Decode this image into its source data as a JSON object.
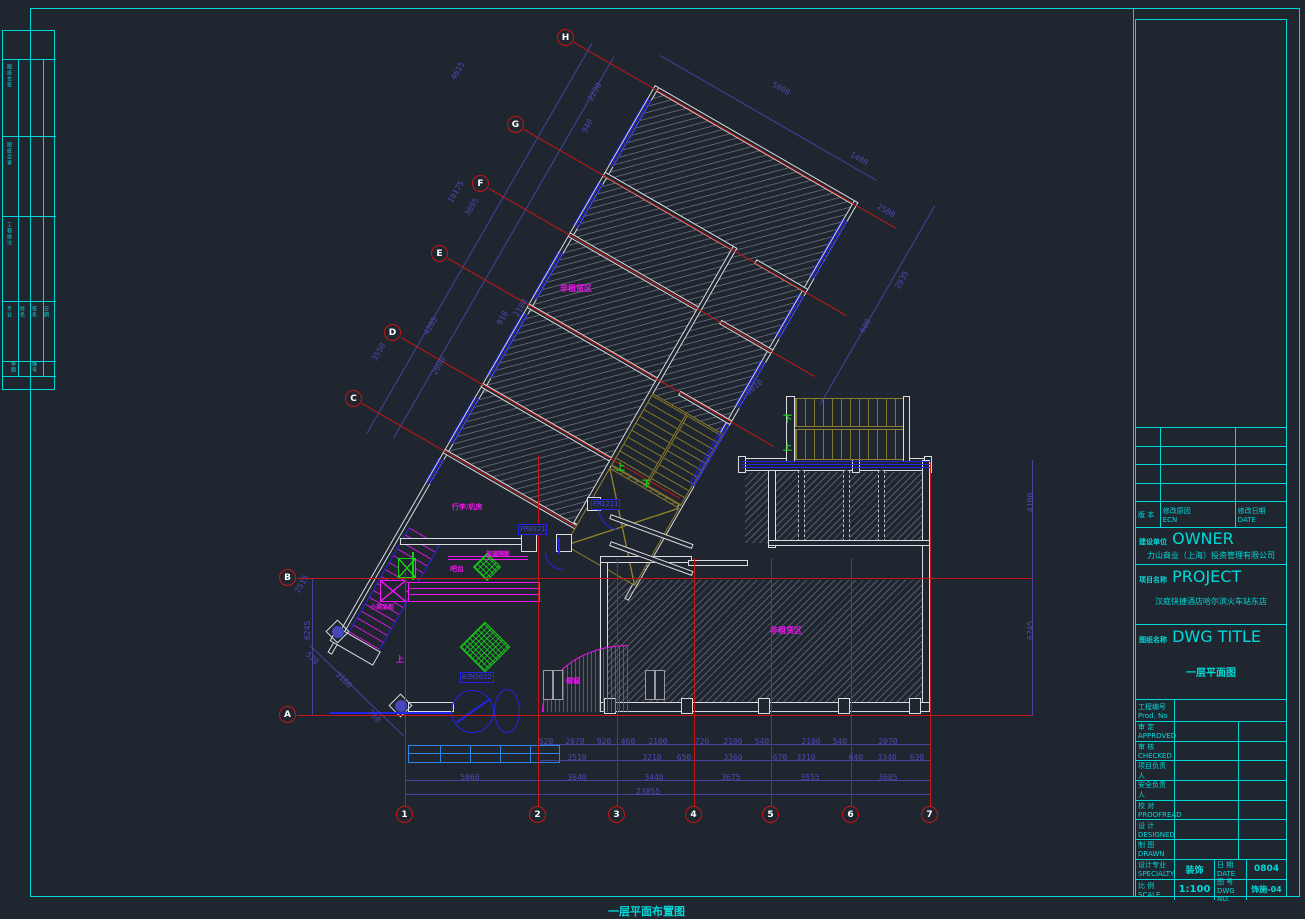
{
  "sheet": {
    "caption": "一层平面布置图"
  },
  "colors": {
    "background": "#20262f",
    "cyan": "#00d9d9",
    "grid_red": "#c81414",
    "dimension_navy": "#4a4ab4",
    "annotation_magenta": "#f014f0",
    "green": "#18d018",
    "door_blue": "#2424e8",
    "stair_olive": "#8c7e2a",
    "wall_white": "#d9dde2",
    "entry_blue": "#2e86e8"
  },
  "grid": {
    "letters": [
      {
        "label": "H",
        "x": 566,
        "y": 38,
        "line": "diag",
        "len": 372
      },
      {
        "label": "G",
        "x": 516,
        "y": 125,
        "line": "diag",
        "len": 372
      },
      {
        "label": "F",
        "x": 481,
        "y": 184,
        "line": "diag",
        "len": 376
      },
      {
        "label": "E",
        "x": 440,
        "y": 254,
        "line": "diag",
        "len": 376
      },
      {
        "label": "D",
        "x": 393,
        "y": 333,
        "line": "diag",
        "len": 322
      },
      {
        "label": "C",
        "x": 354,
        "y": 399,
        "line": "diag",
        "len": 246
      },
      {
        "label": "B",
        "x": 288,
        "y": 578,
        "line": "h",
        "x2": 1032
      },
      {
        "label": "A",
        "x": 288,
        "y": 715,
        "line": "h",
        "x2": 1032
      }
    ],
    "numbers": [
      {
        "label": "1",
        "x": 405,
        "top": 572
      },
      {
        "label": "2",
        "x": 538,
        "top": 455
      },
      {
        "label": "3",
        "x": 617,
        "top": 558
      },
      {
        "label": "4",
        "x": 694,
        "top": 558
      },
      {
        "label": "5",
        "x": 771,
        "top": 558
      },
      {
        "label": "6",
        "x": 851,
        "top": 558
      },
      {
        "label": "7",
        "x": 930,
        "top": 462
      }
    ],
    "number_bubble_y": 806
  },
  "dims": {
    "bottom_rows": [
      {
        "y": 737,
        "items": [
          {
            "t": "520",
            "x": 546
          },
          {
            "t": "2070",
            "x": 575
          },
          {
            "t": "920",
            "x": 604
          },
          {
            "t": "460",
            "x": 628
          },
          {
            "t": "2100",
            "x": 658
          },
          {
            "t": "720",
            "x": 702
          },
          {
            "t": "2100",
            "x": 733
          },
          {
            "t": "540",
            "x": 762
          },
          {
            "t": "2100",
            "x": 811
          },
          {
            "t": "540",
            "x": 840
          },
          {
            "t": "2070",
            "x": 888
          }
        ]
      },
      {
        "y": 753,
        "items": [
          {
            "t": "3510",
            "x": 577
          },
          {
            "t": "3210",
            "x": 652
          },
          {
            "t": "650",
            "x": 684
          },
          {
            "t": "3360",
            "x": 733
          },
          {
            "t": "670",
            "x": 780
          },
          {
            "t": "3310",
            "x": 806
          },
          {
            "t": "640",
            "x": 856
          },
          {
            "t": "3340",
            "x": 887
          },
          {
            "t": "630",
            "x": 917
          }
        ]
      },
      {
        "y": 773,
        "items": [
          {
            "t": "5860",
            "x": 470
          },
          {
            "t": "3640",
            "x": 577
          },
          {
            "t": "3440",
            "x": 654
          },
          {
            "t": "3675",
            "x": 731
          },
          {
            "t": "3555",
            "x": 810
          },
          {
            "t": "3685",
            "x": 888
          }
        ]
      },
      {
        "y": 787,
        "items": [
          {
            "t": "23855",
            "x": 648
          }
        ]
      }
    ],
    "rotated": [
      {
        "t": "4615",
        "x": 449,
        "y": 77,
        "r": -60
      },
      {
        "t": "2230",
        "x": 586,
        "y": 98,
        "r": -60
      },
      {
        "t": "940",
        "x": 580,
        "y": 130,
        "r": -60
      },
      {
        "t": "10175",
        "x": 446,
        "y": 200,
        "r": -60
      },
      {
        "t": "3695",
        "x": 463,
        "y": 213,
        "r": -60
      },
      {
        "t": "910",
        "x": 495,
        "y": 322,
        "r": -60
      },
      {
        "t": "2100",
        "x": 512,
        "y": 314,
        "r": -60
      },
      {
        "t": "4205",
        "x": 422,
        "y": 332,
        "r": -60
      },
      {
        "t": "2090",
        "x": 430,
        "y": 372,
        "r": -60
      },
      {
        "t": "3550",
        "x": 370,
        "y": 358,
        "r": -60
      },
      {
        "t": "5000",
        "x": 775,
        "y": 80,
        "r": 30
      },
      {
        "t": "1400",
        "x": 853,
        "y": 150,
        "r": 30
      },
      {
        "t": "2500",
        "x": 880,
        "y": 202,
        "r": 30
      },
      {
        "t": "2935",
        "x": 893,
        "y": 286,
        "r": -60
      },
      {
        "t": "600",
        "x": 858,
        "y": 330,
        "r": -60
      },
      {
        "t": "570",
        "x": 310,
        "y": 650,
        "r": 44
      },
      {
        "t": "3180",
        "x": 340,
        "y": 670,
        "r": 44
      },
      {
        "t": "750",
        "x": 372,
        "y": 708,
        "r": 44
      },
      {
        "t": "2515",
        "x": 293,
        "y": 590,
        "r": -60
      },
      {
        "t": "6245",
        "x": 303,
        "y": 640,
        "r": -90
      },
      {
        "t": "6245",
        "x": 1026,
        "y": 640,
        "r": -90
      },
      {
        "t": "4100",
        "x": 1026,
        "y": 512,
        "r": -90
      },
      {
        "t": "3010",
        "x": 744,
        "y": 390,
        "r": -40
      }
    ]
  },
  "labels": {
    "magenta": [
      {
        "t": "非租赁区",
        "x": 560,
        "y": 283,
        "s": 8
      },
      {
        "t": "非租赁区",
        "x": 770,
        "y": 625,
        "s": 8
      },
      {
        "t": "行李/机房",
        "x": 452,
        "y": 502,
        "s": 7
      },
      {
        "t": "玻璃隔断",
        "x": 486,
        "y": 549,
        "s": 6
      },
      {
        "t": "吧台",
        "x": 450,
        "y": 564,
        "s": 7
      },
      {
        "t": "小商品柜",
        "x": 370,
        "y": 602,
        "s": 6
      },
      {
        "t": "橱窗",
        "x": 566,
        "y": 676,
        "s": 7
      },
      {
        "t": "上",
        "x": 396,
        "y": 654,
        "s": 8
      }
    ],
    "green": [
      {
        "t": "上",
        "x": 616,
        "y": 460
      },
      {
        "t": "下",
        "x": 642,
        "y": 477
      },
      {
        "t": "下",
        "x": 783,
        "y": 412
      },
      {
        "t": "上",
        "x": 783,
        "y": 440
      }
    ],
    "doors": [
      {
        "t": "FM0821",
        "x": 518,
        "y": 524
      },
      {
        "t": "FM1221",
        "x": 591,
        "y": 499
      },
      {
        "t": "BZM3022",
        "x": 460,
        "y": 672
      }
    ]
  },
  "left_strip": {
    "cells": [
      {
        "t": "图纸会签",
        "x": 6,
        "y": 64,
        "h": 66
      },
      {
        "t": "图纸目录",
        "x": 6,
        "y": 142,
        "h": 66
      },
      {
        "t": "工程做法",
        "x": 6,
        "y": 222,
        "h": 70
      },
      {
        "t": "专业",
        "x": 6,
        "y": 306,
        "h": 50
      },
      {
        "t": "姓名",
        "x": 19,
        "y": 306,
        "h": 50
      },
      {
        "t": "签名",
        "x": 31,
        "y": 306,
        "h": 50
      },
      {
        "t": "日期",
        "x": 43,
        "y": 306,
        "h": 50
      },
      {
        "t": "审图",
        "x": 10,
        "y": 361,
        "h": 14
      },
      {
        "t": "编号",
        "x": 31,
        "y": 361,
        "h": 14
      }
    ]
  },
  "title_block": {
    "rev_header": {
      "col1": "版 本",
      "col2": "修改原因",
      "col2_en": "ECN",
      "col3": "修改日期",
      "col3_en": "DATE"
    },
    "owner_label": "建设单位",
    "owner_en": "OWNER",
    "owner": "力山商业（上海）投资管理有限公司",
    "project_label": "项目名称",
    "project_en": "PROJECT",
    "project": "汉庭快捷酒店哈尔滨火车站东店",
    "dwg_label": "图纸名称",
    "dwg_en": "DWG TITLE",
    "dwg": "一层平面图",
    "prod_label": "工程编号",
    "prod_en": "Prod. No",
    "rows": [
      {
        "l": "审 定",
        "en": "APPROVED"
      },
      {
        "l": "审 核",
        "en": "CHECKED"
      },
      {
        "l": "项目负责人",
        "en": ""
      },
      {
        "l": "安全负责人",
        "en": ""
      },
      {
        "l": "校 对",
        "en": "PROOFREAD"
      },
      {
        "l": "设 计",
        "en": "DESIGNED"
      },
      {
        "l": "制 图",
        "en": "DRAWN"
      }
    ],
    "specialty_label": "设计专业",
    "specialty_en": "SPECIALTY",
    "specialty": "装饰",
    "date_label": "日 期",
    "date_en": "DATE",
    "date": "0804",
    "scale_label": "比 例",
    "scale_en": "SCALE",
    "scale": "1:100",
    "dwgno_label": "图 号",
    "dwgno_en": "DWG NO.",
    "dwgno": "饰施-04"
  }
}
